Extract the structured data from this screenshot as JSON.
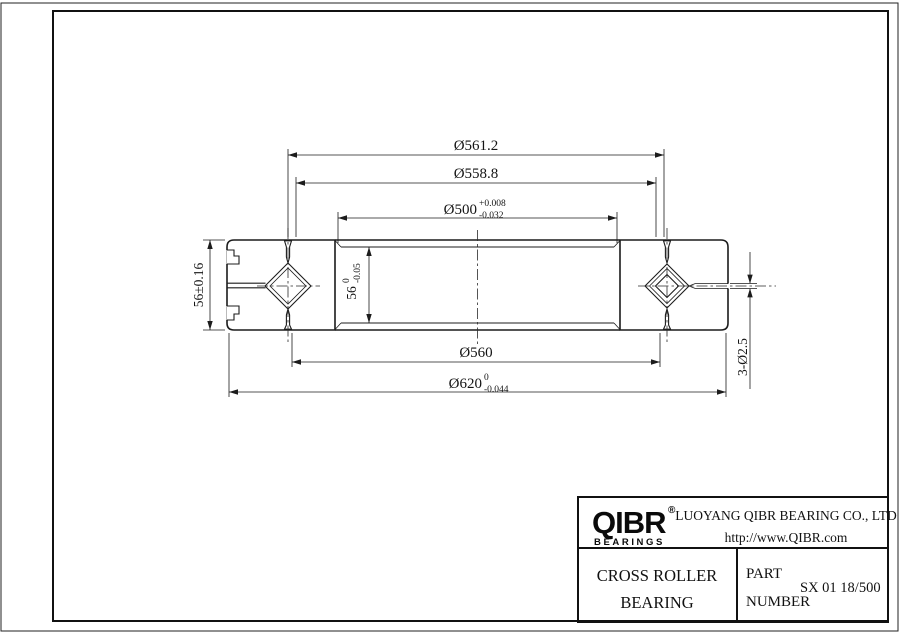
{
  "drawing": {
    "dimensions": {
      "d561": "Ø561.2",
      "d558": "Ø558.8",
      "d500": "Ø500",
      "d500_up": "+0.008",
      "d500_dn": "-0.032",
      "d560": "Ø560",
      "d620": "Ø620",
      "d620_up": "0",
      "d620_dn": "-0.044",
      "w_outer": "56±0.16",
      "w_inner": "56",
      "w_inner_up": "0",
      "w_inner_dn": "-0.05",
      "holes": "3-Ø2.5"
    }
  },
  "title_block": {
    "brand": "QIBR",
    "reg": "®",
    "brand_sub": "BEARINGS",
    "company": "LUOYANG QIBR BEARING CO., LTD",
    "website": "http://www.QIBR.com",
    "product1": "CROSS ROLLER",
    "product2": "BEARING",
    "part1": "PART",
    "part2": "NUMBER",
    "part_number": "SX 01 18/500"
  }
}
